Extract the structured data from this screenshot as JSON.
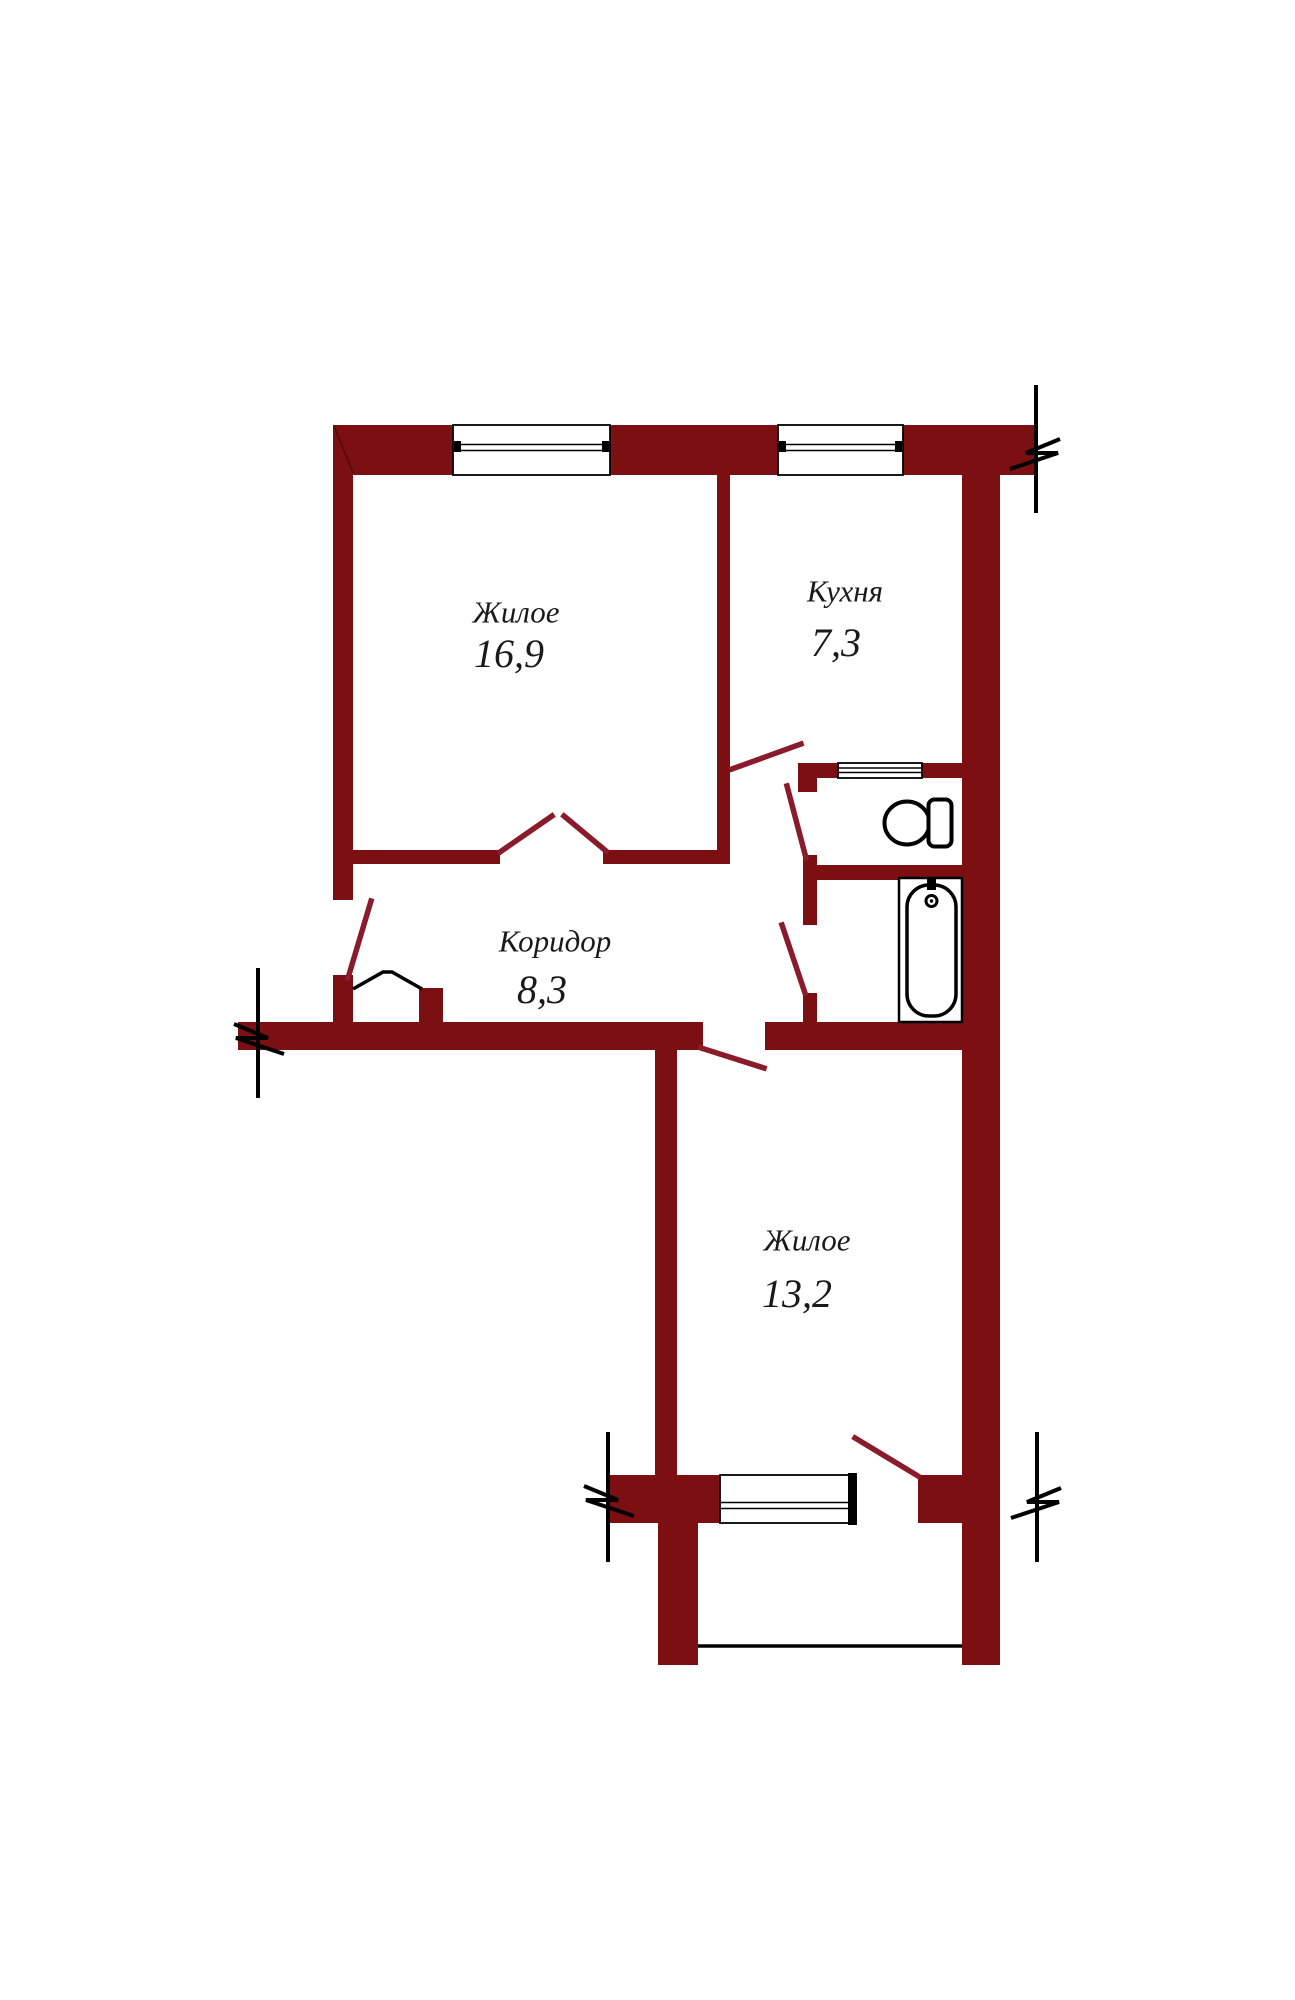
{
  "plan": {
    "type": "apartment-floor-plan",
    "rooms": [
      {
        "name": "Жилое",
        "area": "16,9"
      },
      {
        "name": "Кухня",
        "area": "7,3"
      },
      {
        "name": "Коридор",
        "area": "8,3"
      },
      {
        "name": "Жилое",
        "area": "13,2"
      }
    ],
    "fixtures": [
      {
        "name": "toilet"
      },
      {
        "name": "bathtub"
      }
    ],
    "features": {
      "windows": 3,
      "vent_window": 1,
      "balcony": 1,
      "section_marks": 4
    },
    "colors": {
      "wall": "#7b0f12",
      "door": "#8a1b2a",
      "line": "#000000",
      "text": "#1a1a1a",
      "bg": "#ffffff"
    }
  }
}
